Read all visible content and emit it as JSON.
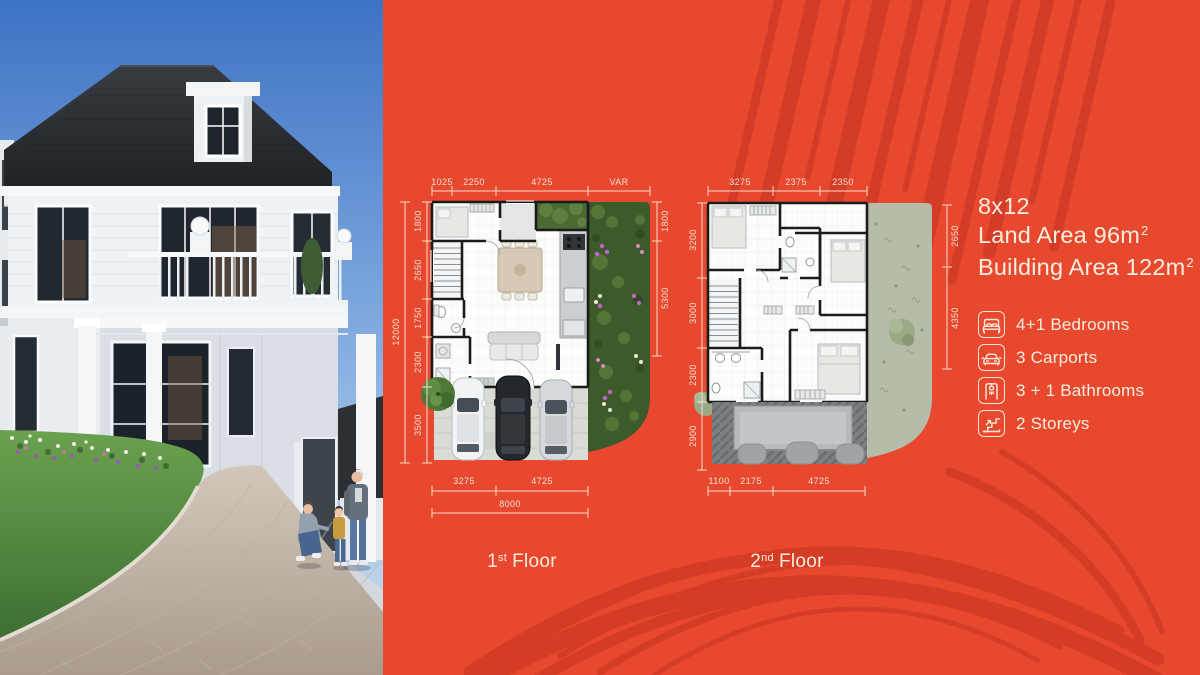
{
  "colors": {
    "panel_red": "#e8492e",
    "texture_red": "#cf3a25",
    "cream": "#f6ecdd",
    "plan_wall": "#1b1b1b",
    "garden_green": "#3d5a2b",
    "roof_gray": "#7b8084"
  },
  "specs": {
    "size": "8x12",
    "land_area": "Land Area 96m",
    "building_area": "Building Area 122m",
    "area_sup": "2"
  },
  "features": [
    {
      "icon": "bed-icon",
      "label": "4+1 Bedrooms"
    },
    {
      "icon": "car-icon",
      "label": "3 Carports"
    },
    {
      "icon": "shower-icon",
      "label": "3 + 1 Bathrooms"
    },
    {
      "icon": "stairs-icon",
      "label": "2 Storeys"
    }
  ],
  "plan1": {
    "label": {
      "num": "1",
      "sup": "st",
      "word": "Floor"
    },
    "dims": {
      "top": [
        "1025",
        "2250",
        "4725",
        "VAR"
      ],
      "left_total": "12000",
      "left": [
        "1800",
        "2650",
        "1750",
        "2300",
        "3500"
      ],
      "right": [
        "1800",
        "5300"
      ],
      "bottom": [
        "3275",
        "4725"
      ],
      "bottom_total": "8000"
    }
  },
  "plan2": {
    "label": {
      "num": "2",
      "sup": "nd",
      "word": "Floor"
    },
    "dims": {
      "top": [
        "3275",
        "2375",
        "2350"
      ],
      "left": [
        "3200",
        "3000",
        "2300",
        "2900"
      ],
      "right": [
        "2650",
        "4350"
      ],
      "bottom": [
        "1100",
        "2175",
        "4725"
      ]
    }
  }
}
